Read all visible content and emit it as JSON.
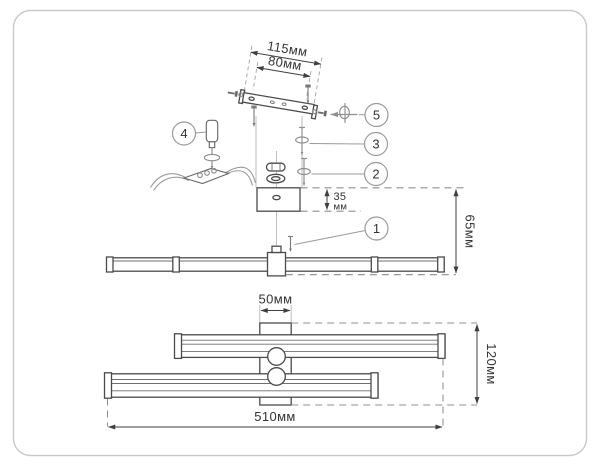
{
  "drawing": {
    "callouts": [
      {
        "number": "1"
      },
      {
        "number": "2"
      },
      {
        "number": "3"
      },
      {
        "number": "4"
      },
      {
        "number": "5"
      }
    ],
    "dimensions": {
      "bracket_length": "115мм",
      "bracket_hole_spacing": "80мм",
      "canopy_depth": "35",
      "canopy_depth_unit": "мм",
      "mount_height": "65мм",
      "canopy_width": "50мм",
      "fixture_height": "120мм",
      "fixture_length": "510мм"
    },
    "colors": {
      "line": "#4a4a4a",
      "construction": "#bdbdbd",
      "dashed": "#8f8f8f",
      "text": "#333333",
      "frame": "#c9c9c9",
      "background": "#ffffff"
    }
  }
}
